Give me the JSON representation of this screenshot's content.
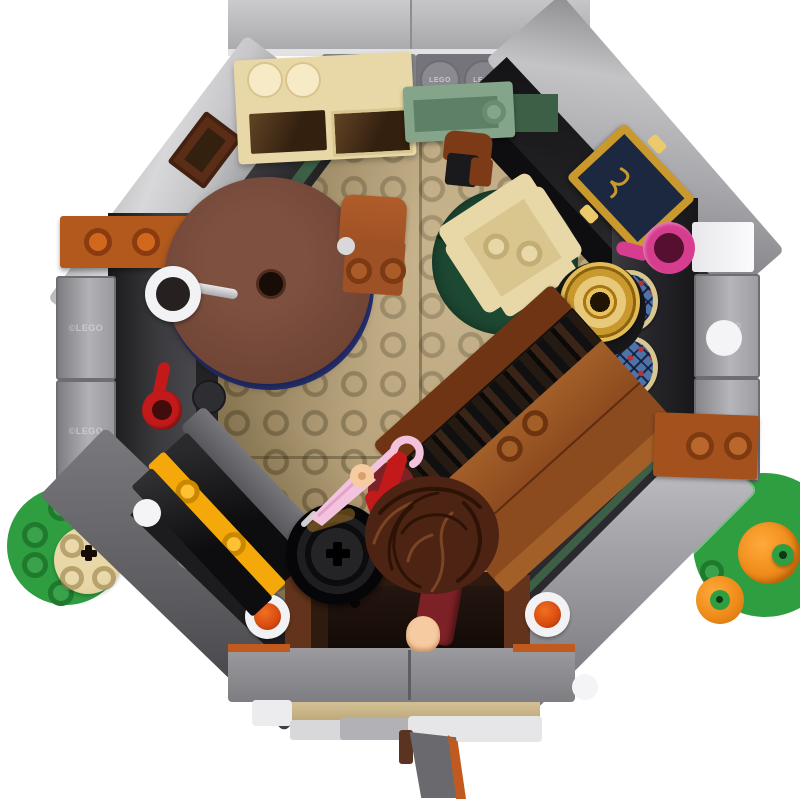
{
  "meta": {
    "title": "Top-down product photo of a LEGO octagonal hobbit-hole room interior",
    "view": "overhead",
    "background": "#ffffff"
  },
  "branding": {
    "stud_text": "LEGO",
    "panel_embossing_left": "©LEGO",
    "panel_embossing_right": "0937©"
  },
  "objects": [
    "octagonal gray brick walls with light gray outer panels",
    "tan studded floor plates",
    "round reddish-brown table on dark blue base",
    "sienna dining chair",
    "tan armchair on dark green round rug",
    "cream dresser with translucent brown glass doors",
    "sage green wall shelf",
    "small sienna chair with black seat",
    "brown wooden bureau with book shelf",
    "black storage chest with yellow trim",
    "black barrel",
    "minifigure with brown curly hair, dark red outfit, flesh hands",
    "light pink umbrella with crook handle",
    "white metal mug on wall hook",
    "red mug on wall hook",
    "magenta pink mug",
    "gold cake stand on black base",
    "gold ornate picture frame with navy picture",
    "two arched stained glass window tiles",
    "green grass circle with tan tree stump",
    "green mound with two orange pumpkins",
    "entrance hallway with two lanterns (trans-orange gems)",
    "front door stack with tan threshold and orange-edged open door"
  ],
  "colors": {
    "white": "#ffffff",
    "roof": "#b6b6b8",
    "roof-hi": "#e2e2e4",
    "wall-outer": "#97979b",
    "wall-outer-hi": "#cfcfd3",
    "wall-mid": "#6a6a6e",
    "wall-dark": "#3b3b3f",
    "wall-black": "#202023",
    "floor": "#b29c74",
    "floor-light": "#cdb88c",
    "hall": "#2e1a0e",
    "hall-trim": "#63341b",
    "hall-dark": "#1c100a",
    "tan": "#e9d8a7",
    "tan-shade": "#d9c58e",
    "glass-brown": "#33200f",
    "sage": "#85a58a",
    "sage-dark": "#5d8066",
    "green-dk": "#3c5f46",
    "table": "#6f4434",
    "table-hi": "#7d5040",
    "table-blue": "#263173",
    "sienna": "#9e5124",
    "sienna-dark": "#7c3a16",
    "rug": "#1d4832",
    "gold": "#c9992e",
    "gold-hi": "#ecca6c",
    "navy": "#1b2840",
    "glass-frame": "#d9c791",
    "glass-blue": "#4e73a8",
    "glass-red": "#b53434",
    "pinkmug": "#d63d8f",
    "pink-light": "#f3c3dd",
    "red": "#c21a1a",
    "darkred": "#7c2125",
    "flesh": "#f6cba1",
    "wig": "#4d2313",
    "wig-dark": "#2d1206",
    "wig-hi": "#7a4522",
    "barrel": "#141414",
    "chest-black": "#0d0d0f",
    "chest-yellow": "#f5a80a",
    "orange-shelf": "#b25a1e",
    "orange-stud": "#d2671f",
    "green": "#2f9e41",
    "green-dkst": "#1f7a2e",
    "pumpkin": "#ef8c1a",
    "pumpkin-dk": "#c96d10",
    "lantern": "#d84a10",
    "silver": "#c9c9cd",
    "bureau": "#8c4a1f",
    "bureau-dk": "#6e3413",
    "bureau-hi": "#a35f28",
    "brick-orange": "#a5511d",
    "door-orange": "#c05a1e",
    "stone": "#8f8f93"
  }
}
